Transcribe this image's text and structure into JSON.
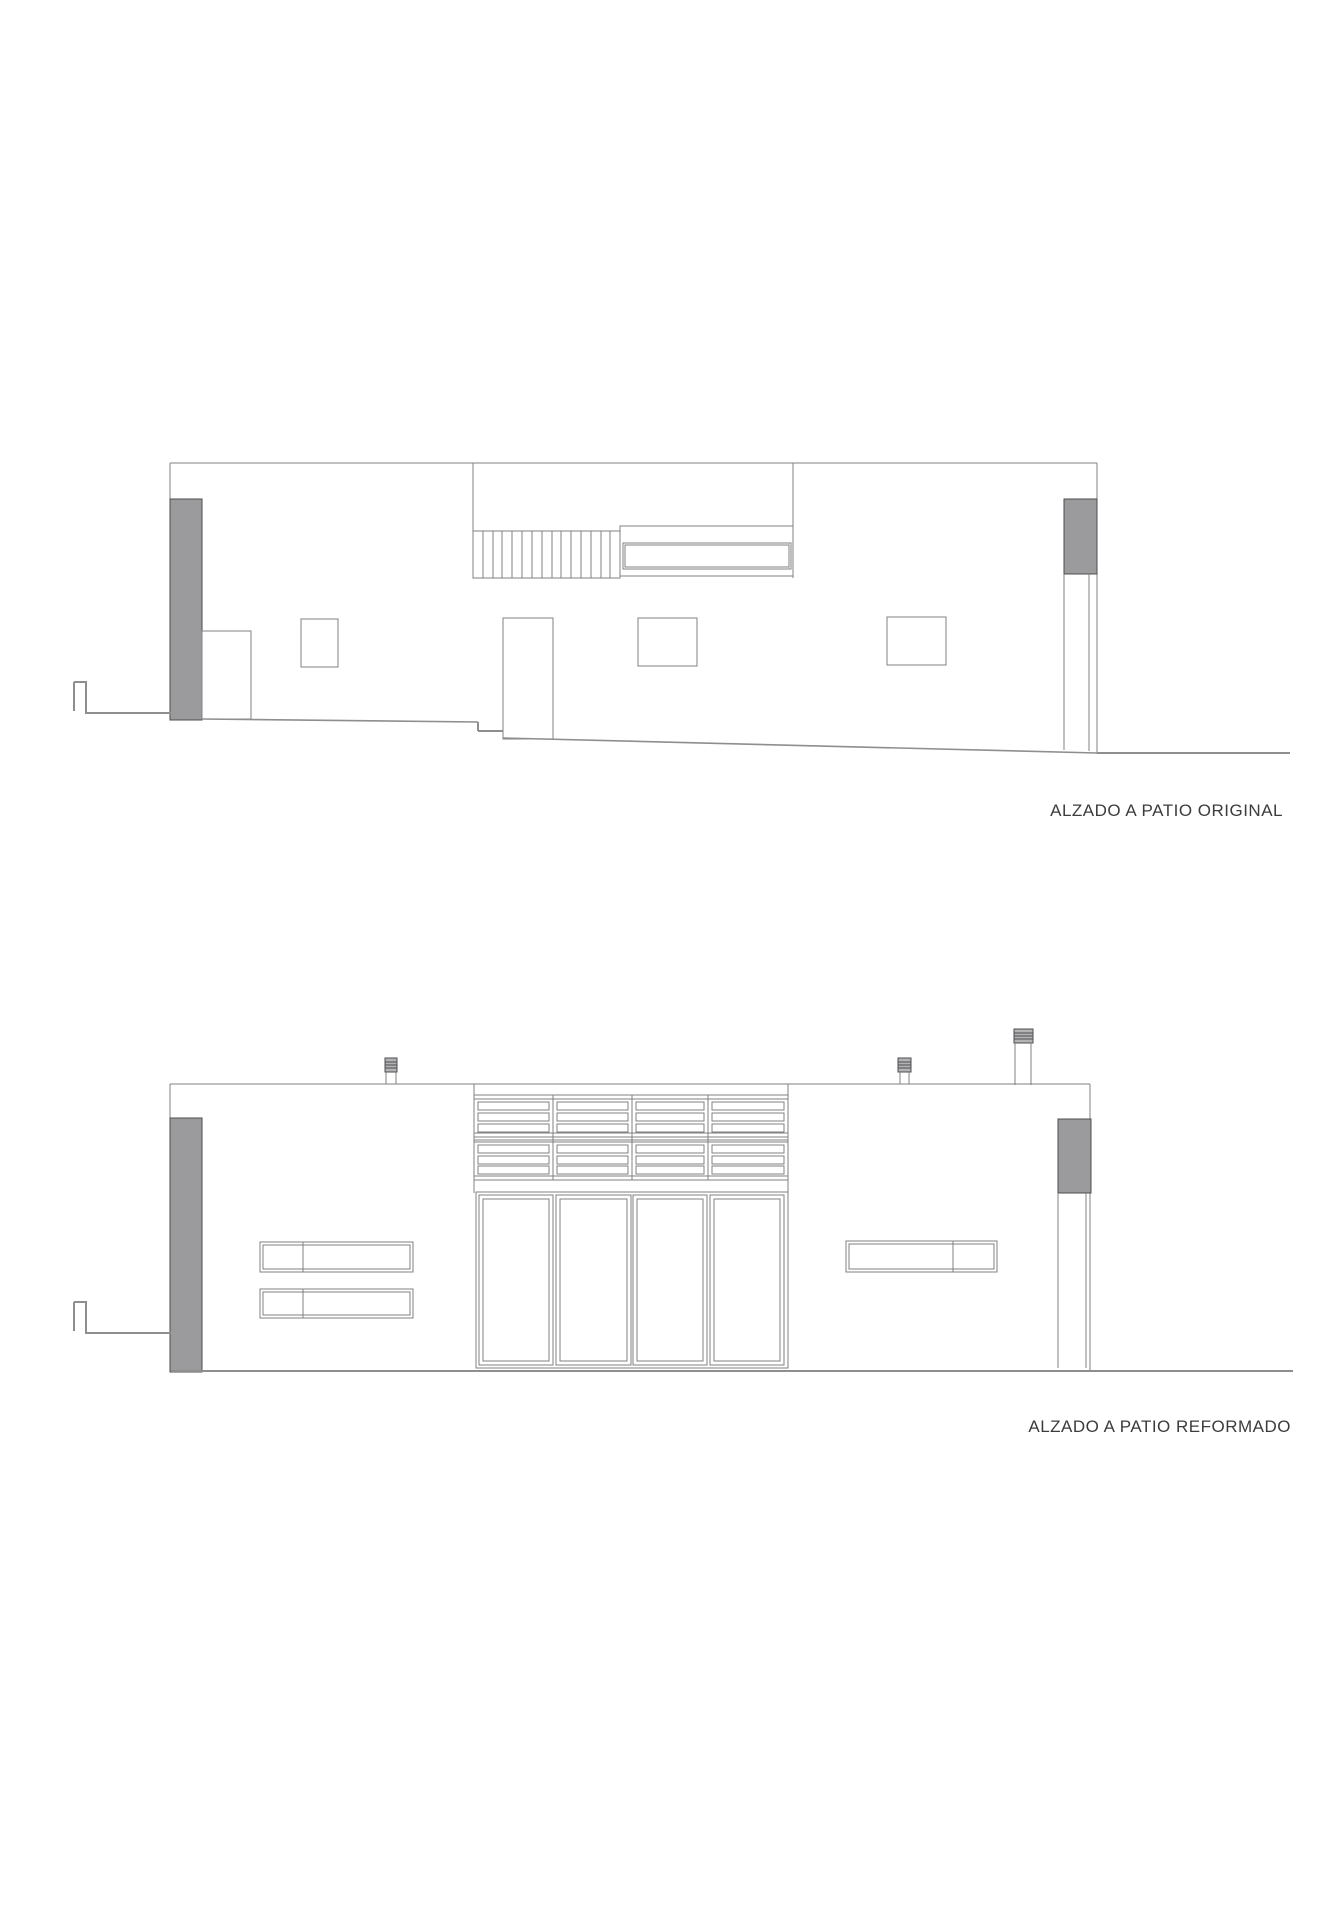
{
  "sheet": {
    "title_original": "ALZADO A PATIO ORIGINAL",
    "title_reformado": "ALZADO A PATIO REFORMADO"
  },
  "colors": {
    "line": "#818181",
    "dark-line": "#4e4e4e",
    "ground-line": "#8e8e8e",
    "fill-gray": "#9b9b9d",
    "cap-fill": "#b3b3b5",
    "text": "#3c3c3c",
    "background": "#ffffff"
  }
}
